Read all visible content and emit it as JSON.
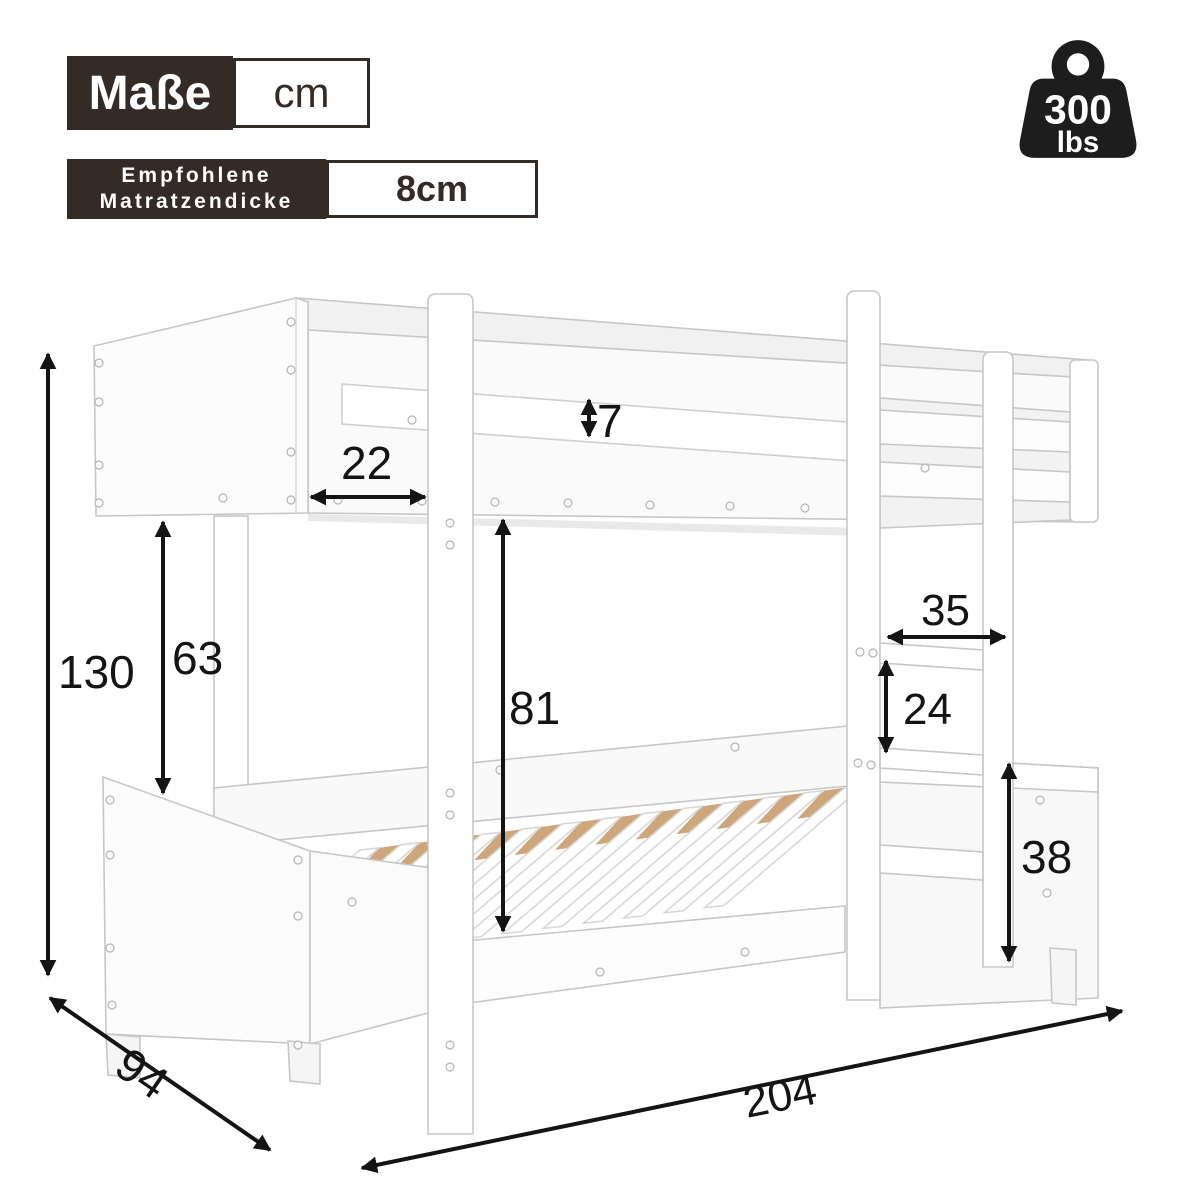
{
  "header": {
    "dimensions_label": "Maße",
    "unit_label": "cm",
    "mattress_label_line1": "Empfohlene",
    "mattress_label_line2": "Matratzendicke",
    "mattress_value": "8cm"
  },
  "weight_badge": {
    "value": "300",
    "unit": "lbs"
  },
  "product": "bunk-bed line drawing",
  "dimensions_cm": {
    "total_height": "130",
    "gap_between_bunks": "63",
    "headboard_inset": "22",
    "guard_rail_thickness": "7",
    "under_bunk_clearance": "81",
    "ladder_width": "35",
    "rung_spacing": "24",
    "lower_frame_height": "38",
    "depth": "94",
    "length": "204"
  },
  "colors": {
    "label_dark": "#342b27",
    "line_black": "#141414",
    "bed_edge": "#c7c7c7",
    "slat_wood": "#cda67a",
    "background": "#ffffff"
  }
}
